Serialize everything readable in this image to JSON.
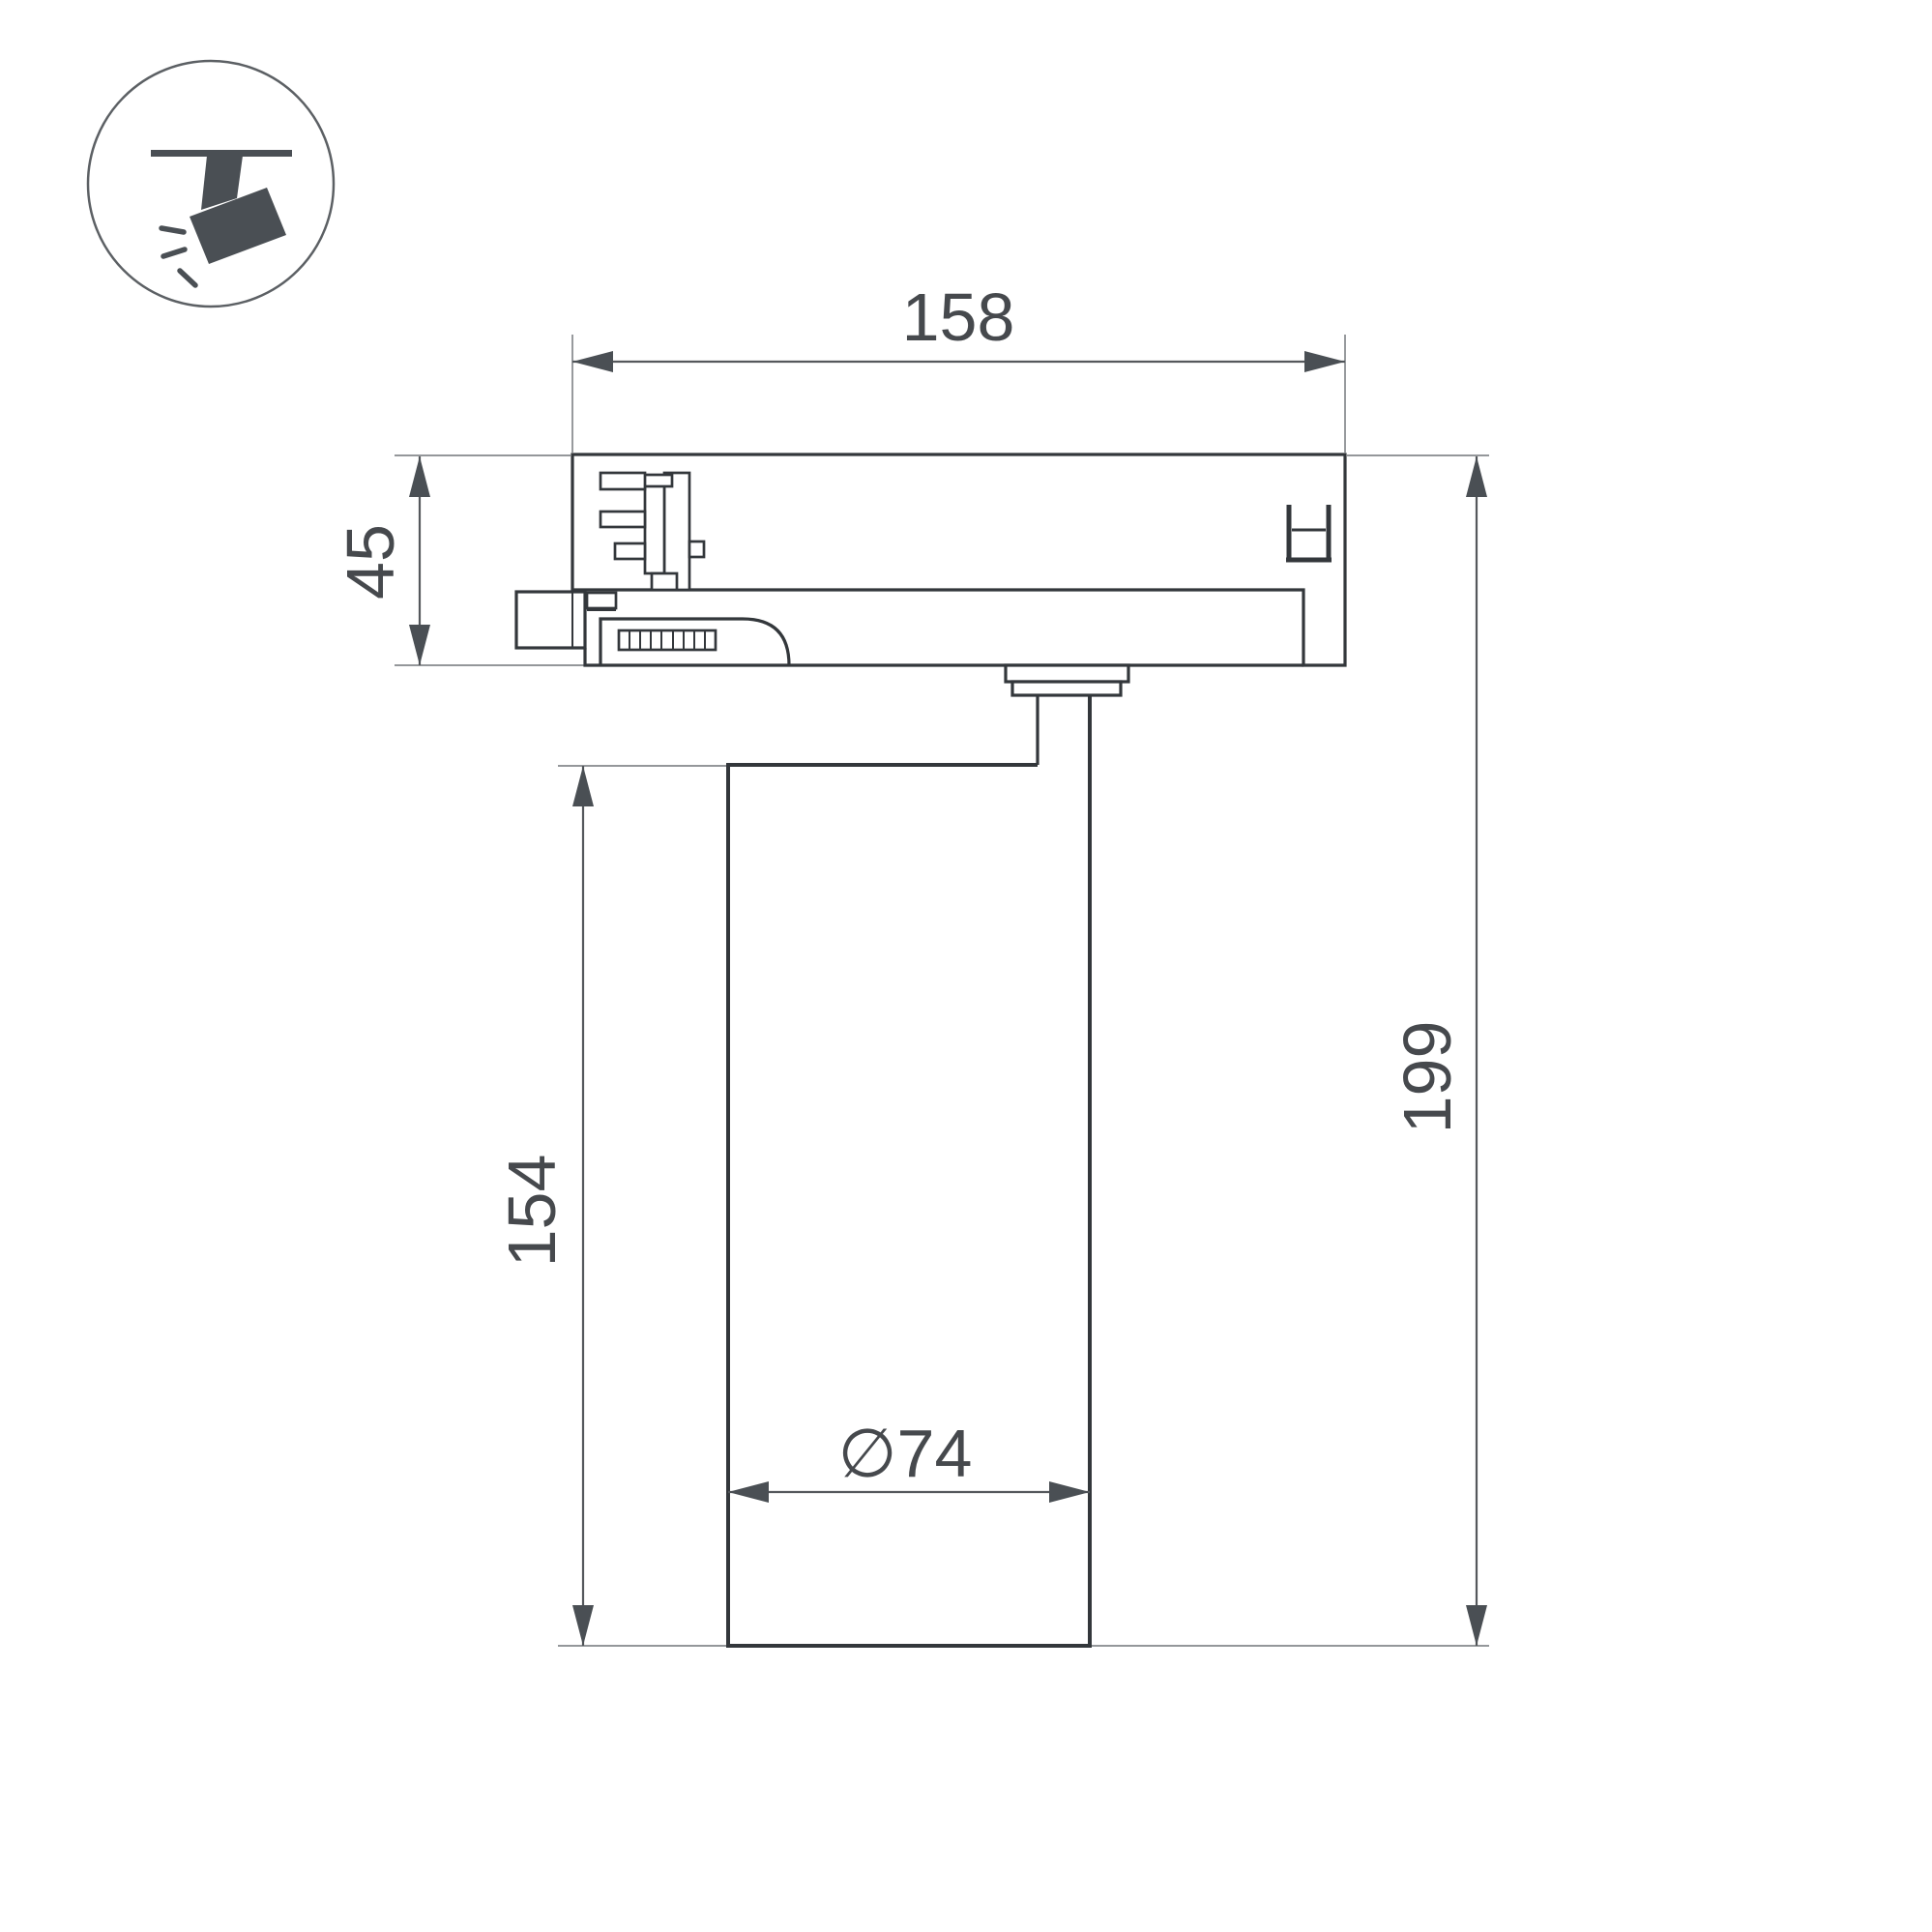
{
  "icon": {
    "name": "track-spotlight-icon"
  },
  "dimensions": {
    "adapter_width_label": "158",
    "adapter_height_label": "45",
    "body_height_label": "154",
    "total_height_label": "199",
    "diameter_label": "∅74"
  },
  "colors": {
    "outline": "#33373b",
    "dimension_line": "#55585c",
    "extension_line": "#85888c",
    "label_text": "#46494d",
    "icon_fill": "#4a4f54",
    "background": "#ffffff"
  }
}
